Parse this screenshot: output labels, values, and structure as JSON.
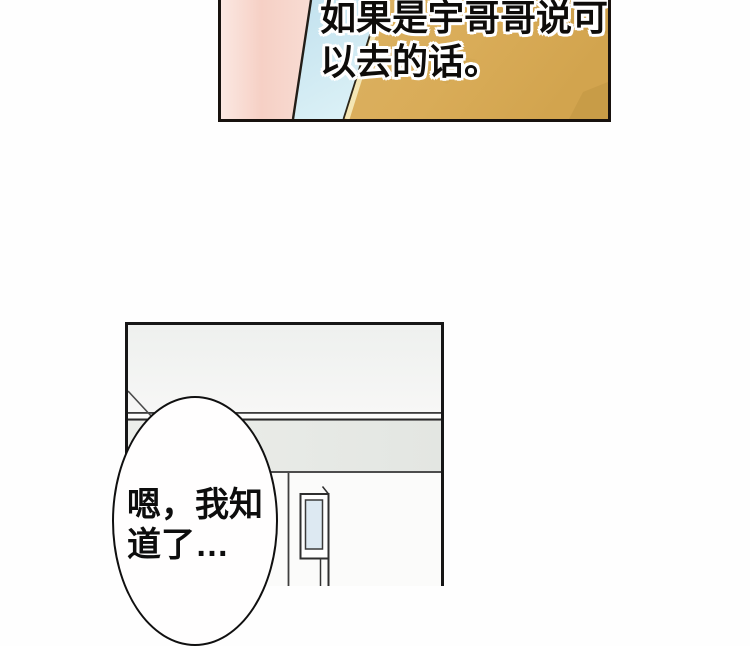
{
  "page": {
    "type": "comic-page",
    "background_color": "#fefefe"
  },
  "panels": {
    "flashback": {
      "caption": {
        "text": "如果是宇哥哥说可以去的话。",
        "lines": [
          "如果是宇哥哥说可",
          "以去的话。"
        ]
      },
      "colors": {
        "wall_pink": "#f6d0c5",
        "wall_pink_light": "#fbe8e2",
        "wall_blue": "#c7e4f0",
        "wall_blue_light": "#daf0f6",
        "wall_gold": "#d9ac58",
        "gold_shadow": "#bd9340",
        "gold_highlight_edge": "#f4e6b4",
        "divider_line": "#221d17",
        "border": "#18120e",
        "text": "#0e0c0a",
        "text_outline": "#ffffff"
      }
    },
    "room": {
      "colors": {
        "wall_upper": "#eff0ee",
        "beam_band": "#e6e8e4",
        "wall_lower": "#fbfbfa",
        "door_glass": "#dde9f2",
        "interior_line": "#3c3c3c",
        "border": "#161616"
      },
      "speech_bubble": {
        "text": "嗯，我知道了…",
        "lines": [
          "嗯，我知",
          "道了…"
        ],
        "fill": "#fffefe",
        "outline": "#101010",
        "text_color": "#0d0d0d"
      }
    }
  }
}
